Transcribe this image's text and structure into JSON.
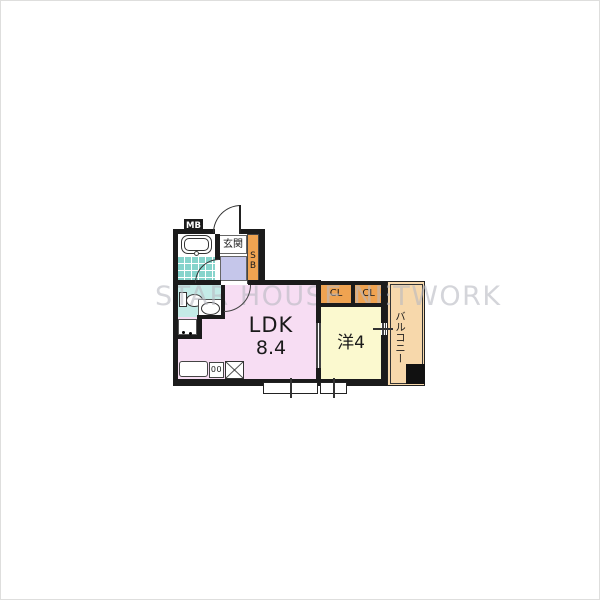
{
  "floorplan": {
    "watermark": "STAR HOUSE NETWORK",
    "rooms": {
      "ldk": {
        "label": "LDK",
        "size": "8.4"
      },
      "western": {
        "label": "洋4"
      },
      "entrance": {
        "label": "玄関"
      },
      "balcony": {
        "label": "バルコニー"
      },
      "closet_left": {
        "label": "CL"
      },
      "closet_right": {
        "label": "CL"
      }
    },
    "fixtures": {
      "meter_box": "MB",
      "shoe_box": "SB",
      "stove_burners": "00"
    },
    "colors": {
      "ldk_pink": "#f7ddf3",
      "western_yellow": "#fbf9cf",
      "closet_orange": "#efa351",
      "balcony_peach": "#f7d8ab",
      "bath_tile_teal": "#86d4cc",
      "washroom_teal": "#c4ebe7",
      "hallway_lavender": "#c5c6ea",
      "wall_black": "#1b1b1b",
      "watermark_gray": "#b9bac2"
    }
  }
}
